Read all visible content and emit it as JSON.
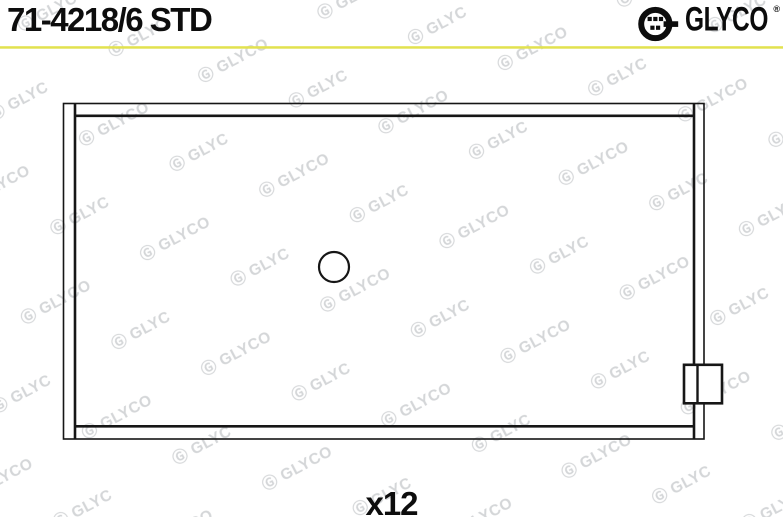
{
  "watermark": {
    "text": "Ⓖ GLYCO",
    "color": "#d4d6d8"
  },
  "header": {
    "part_number": "71-4218/6 STD",
    "brand": {
      "name": "GLYCO",
      "registered_mark": "®"
    },
    "divider_color": "#e2e24f"
  },
  "drawing": {
    "quantity_label": "x12"
  }
}
